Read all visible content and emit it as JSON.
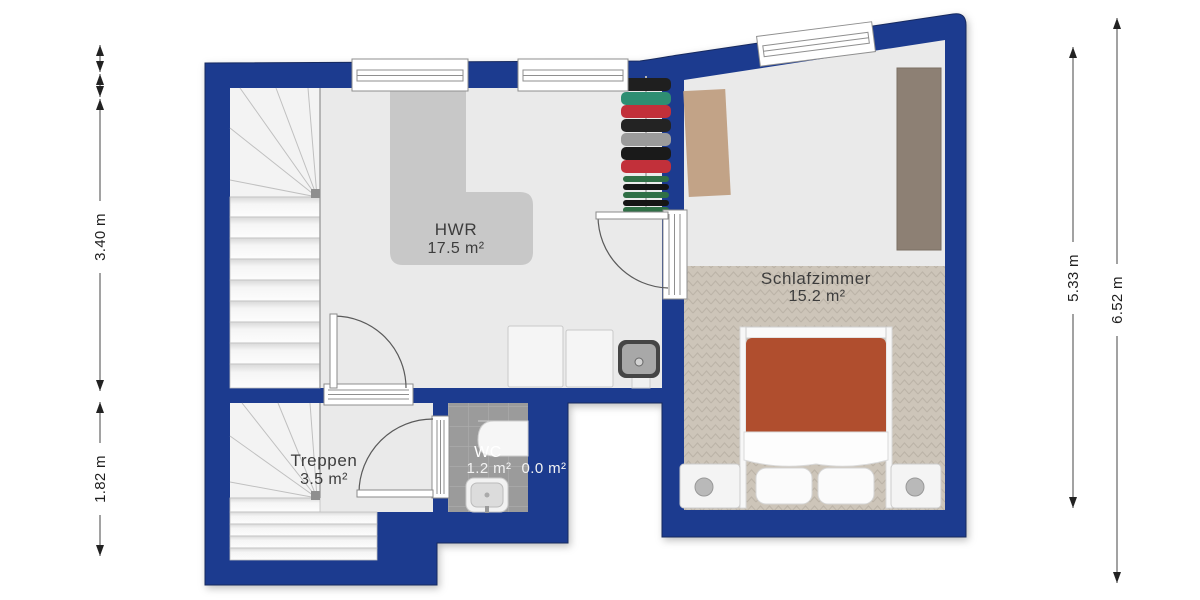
{
  "floorplan": {
    "rooms": {
      "hwr": {
        "name": "HWR",
        "area": "17.5 m²"
      },
      "schlafzimmer": {
        "name": "Schlafzimmer",
        "area": "15.2 m²"
      },
      "treppen": {
        "name": "Treppen",
        "area": "3.5 m²"
      },
      "wc": {
        "name": "WC",
        "area": "1.2 m²"
      },
      "void": {
        "area": "0.0 m²"
      }
    },
    "dimensions": {
      "left_upper": "3.40 m",
      "left_lower": "1.82 m",
      "right_inner": "5.33 m",
      "right_outer": "6.52 m"
    },
    "colors": {
      "wall": "#1e3a8f",
      "floor": "#eaeaea",
      "stairs": "#f3f3f3",
      "carpet": "#cdc5b9",
      "wc_tile": "#9b9b9b",
      "counter": "#c8c8c8",
      "rug": "#c2a387",
      "wardrobe": "#8d8074",
      "duvet": "#b04e2e",
      "background": "#ffffff"
    }
  }
}
